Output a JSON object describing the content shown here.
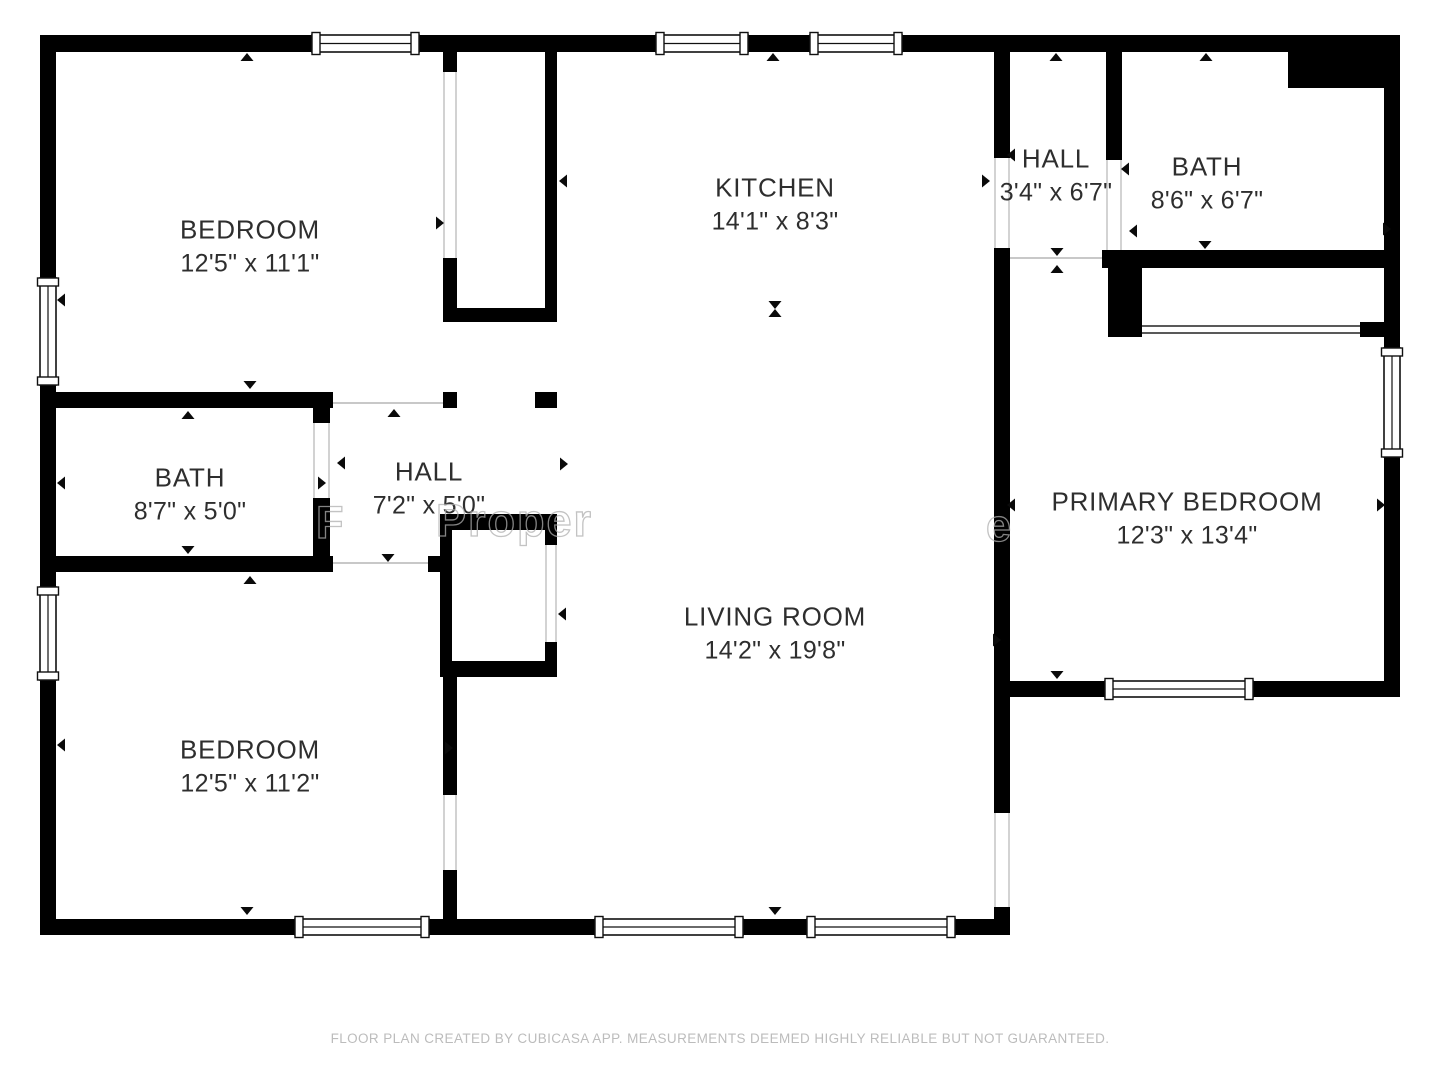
{
  "page": {
    "background": "#ffffff"
  },
  "colors": {
    "wall": "#000000",
    "window_frame": "#111111",
    "label_text": "#2e2e2e",
    "marker": "#0a0a0a",
    "threshold_line": "#b5b5b5",
    "closet_door_line": "#222222",
    "footer_text": "#bcbcbc",
    "watermark_stroke": "#afafaf"
  },
  "rooms": [
    {
      "id": "bedroom-top-left",
      "name": "BEDROOM",
      "dims": "12'5\" x 11'1\""
    },
    {
      "id": "kitchen",
      "name": "KITCHEN",
      "dims": "14'1\" x 8'3\""
    },
    {
      "id": "hall-top-right",
      "name": "HALL",
      "dims": "3'4\" x 6'7\""
    },
    {
      "id": "bath-top-right",
      "name": "BATH",
      "dims": "8'6\" x 6'7\""
    },
    {
      "id": "bath-left",
      "name": "BATH",
      "dims": "8'7\" x 5'0\""
    },
    {
      "id": "hall-left",
      "name": "HALL",
      "dims": "7'2\" x 5'0\""
    },
    {
      "id": "primary-bedroom",
      "name": "PRIMARY BEDROOM",
      "dims": "12'3\" x 13'4\""
    },
    {
      "id": "living-room",
      "name": "LIVING ROOM",
      "dims": "14'2\" x 19'8\""
    },
    {
      "id": "bedroom-bottom-left",
      "name": "BEDROOM",
      "dims": "12'5\" x 11'2\""
    }
  ],
  "watermark": {
    "fragments": [
      {
        "text": "F"
      },
      {
        "text": "Proper"
      },
      {
        "text": "e"
      }
    ]
  },
  "footer": {
    "text": "FLOOR PLAN CREATED BY CUBICASA APP. MEASUREMENTS DEEMED HIGHLY RELIABLE BUT NOT GUARANTEED."
  }
}
